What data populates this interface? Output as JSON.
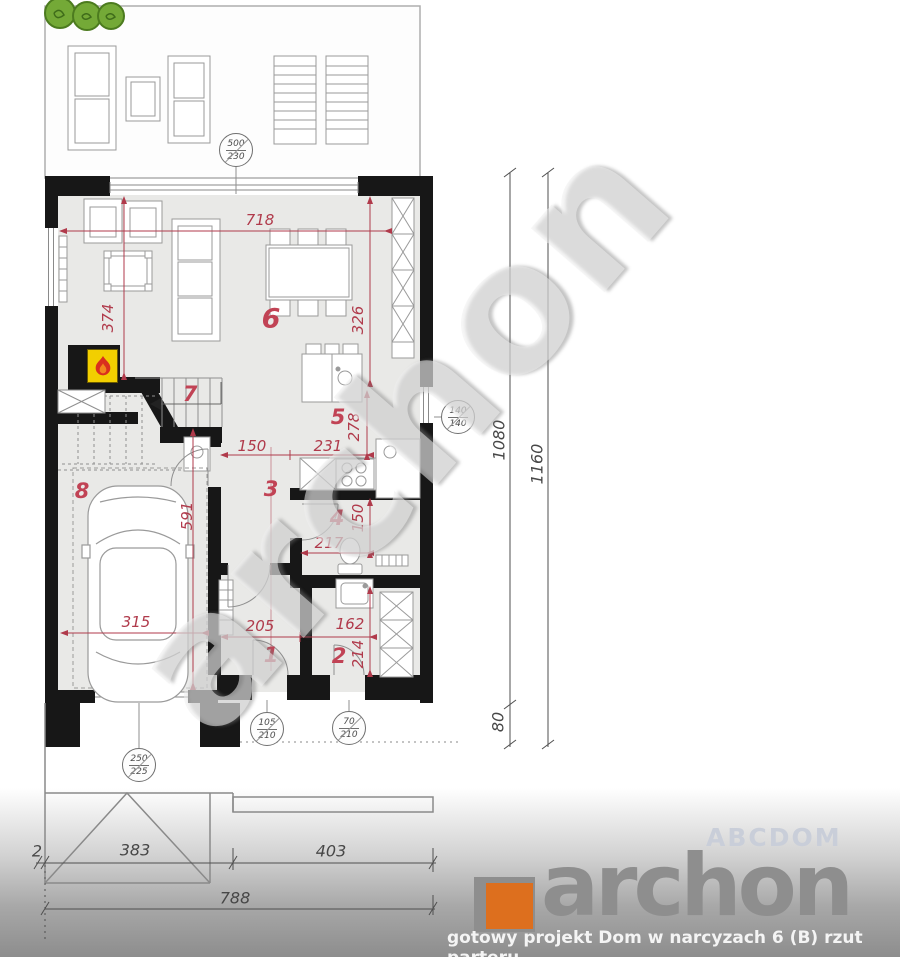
{
  "brand": {
    "logo_text": "archon",
    "tagline": "gotowy projekt Dom w narcyzach 6 (B) rzut parteru",
    "watermark_diagonal": "archon",
    "watermark_corner": "ABCDOM",
    "logo_orange": "#dd6f1e",
    "logo_gray": "#8e8e8e"
  },
  "rooms": {
    "entry": "1",
    "utility": "2",
    "hall": "3",
    "wc": "4",
    "kitchen": "5",
    "living": "6",
    "stairs": "7",
    "garage": "8"
  },
  "dims_red": {
    "living_width": "718",
    "living_left_depth": "374",
    "living_right_depth": "326",
    "kitchen_depth": "278",
    "kitchen_width": "231",
    "hall_width": "150",
    "wc_width": "217",
    "wc_depth": "150",
    "garage_depth": "591",
    "garage_width": "315",
    "entry_width": "205",
    "utility_width": "162",
    "utility_depth": "214"
  },
  "dims_black": {
    "side_inner": "1080",
    "side_outer": "1160",
    "side_offset": "80",
    "front_sliver": "2",
    "front_garage": "383",
    "front_right": "403",
    "front_total": "788"
  },
  "markers": {
    "terrace_door": {
      "w": "500",
      "h": "230"
    },
    "kitchen_window": {
      "w": "140",
      "h": "140"
    },
    "entry_door": {
      "w": "105",
      "h": "210"
    },
    "utility_door": {
      "w": "70",
      "h": "210"
    },
    "garage_door": {
      "w": "250",
      "h": "225"
    }
  },
  "colors": {
    "dim_red": "#b03a4b",
    "wall_black": "#171717",
    "floor_gray": "#e9e9e7",
    "fireplace_yellow": "#f2cf00",
    "flame_red": "#d92f1e",
    "bush_green": "#74a937"
  }
}
